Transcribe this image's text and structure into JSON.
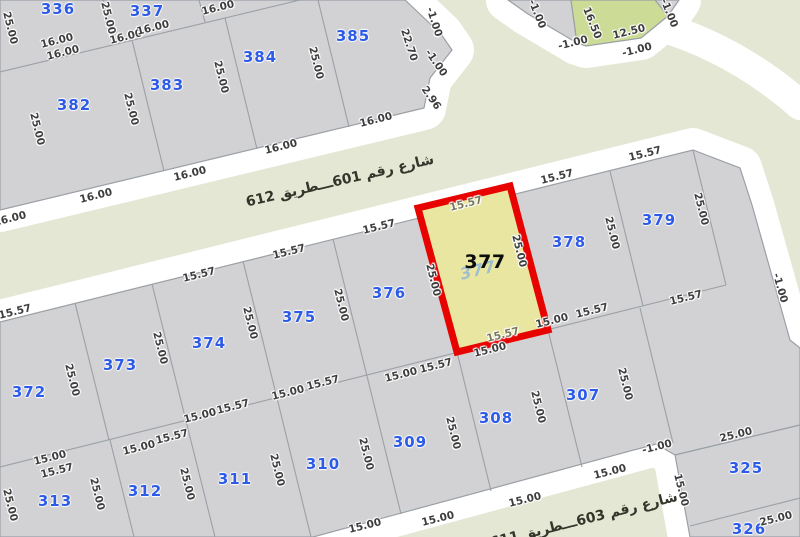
{
  "map": {
    "streets": [
      {
        "name": "شارع رقم 601ـــطريق 612",
        "x": 340,
        "y": 181,
        "rot": -13
      },
      {
        "name": "شارع رقم 603ـــطريق 611",
        "x": 584,
        "y": 520,
        "rot": -14
      }
    ],
    "selected_parcel": {
      "number": "377",
      "shadow_number": "377"
    },
    "parcel_numbers": [
      {
        "n": "336",
        "x": 58,
        "y": 9
      },
      {
        "n": "337",
        "x": 147,
        "y": 11
      },
      {
        "n": "382",
        "x": 74,
        "y": 105
      },
      {
        "n": "383",
        "x": 167,
        "y": 85
      },
      {
        "n": "384",
        "x": 260,
        "y": 57
      },
      {
        "n": "385",
        "x": 353,
        "y": 36
      },
      {
        "n": "372",
        "x": 29,
        "y": 392
      },
      {
        "n": "373",
        "x": 120,
        "y": 365
      },
      {
        "n": "374",
        "x": 209,
        "y": 343
      },
      {
        "n": "375",
        "x": 299,
        "y": 317
      },
      {
        "n": "376",
        "x": 389,
        "y": 293
      },
      {
        "n": "378",
        "x": 569,
        "y": 242
      },
      {
        "n": "379",
        "x": 659,
        "y": 220
      },
      {
        "n": "313",
        "x": 55,
        "y": 501
      },
      {
        "n": "312",
        "x": 145,
        "y": 491
      },
      {
        "n": "311",
        "x": 235,
        "y": 479
      },
      {
        "n": "310",
        "x": 323,
        "y": 464
      },
      {
        "n": "309",
        "x": 410,
        "y": 442
      },
      {
        "n": "308",
        "x": 496,
        "y": 418
      },
      {
        "n": "307",
        "x": 583,
        "y": 395
      },
      {
        "n": "325",
        "x": 746,
        "y": 468
      },
      {
        "n": "326",
        "x": 749,
        "y": 529
      }
    ],
    "dimensions": [
      {
        "t": "25.00",
        "x": 10,
        "y": 28,
        "r": 76
      },
      {
        "t": "16.00",
        "x": 57,
        "y": 41,
        "r": -14
      },
      {
        "t": "16.00",
        "x": 63,
        "y": 53,
        "r": -14
      },
      {
        "t": "25.00",
        "x": 108,
        "y": 18,
        "r": 76
      },
      {
        "t": "16.00",
        "x": 126,
        "y": 37,
        "r": -14
      },
      {
        "t": "16.00",
        "x": 153,
        "y": 28,
        "r": -14
      },
      {
        "t": "16.00",
        "x": 218,
        "y": 8,
        "r": -14
      },
      {
        "t": "25.00",
        "x": 37,
        "y": 129,
        "r": 76
      },
      {
        "t": "25.00",
        "x": 131,
        "y": 109,
        "r": 76
      },
      {
        "t": "25.00",
        "x": 221,
        "y": 77,
        "r": 76
      },
      {
        "t": "25.00",
        "x": 316,
        "y": 63,
        "r": 76
      },
      {
        "t": "22.70",
        "x": 409,
        "y": 45,
        "r": 72
      },
      {
        "t": "-1.00",
        "x": 434,
        "y": 22,
        "r": 72
      },
      {
        "t": "-1.00",
        "x": 436,
        "y": 63,
        "r": 55
      },
      {
        "t": "2.96",
        "x": 431,
        "y": 98,
        "r": 55
      },
      {
        "t": "16.00",
        "x": 10,
        "y": 219,
        "r": -14
      },
      {
        "t": "16.00",
        "x": 96,
        "y": 196,
        "r": -14
      },
      {
        "t": "16.00",
        "x": 190,
        "y": 174,
        "r": -14
      },
      {
        "t": "16.00",
        "x": 281,
        "y": 147,
        "r": -14
      },
      {
        "t": "16.00",
        "x": 376,
        "y": 120,
        "r": -14
      },
      {
        "t": "-1.00",
        "x": 537,
        "y": 14,
        "r": 68
      },
      {
        "t": "16.50",
        "x": 592,
        "y": 23,
        "r": 68
      },
      {
        "t": "12.50",
        "x": 629,
        "y": 32,
        "r": -14
      },
      {
        "t": "-1.00",
        "x": 573,
        "y": 43,
        "r": -14
      },
      {
        "t": "-1.00",
        "x": 637,
        "y": 50,
        "r": -14
      },
      {
        "t": "-1.00",
        "x": 669,
        "y": 13,
        "r": 68
      },
      {
        "t": "15.57",
        "x": 15,
        "y": 312,
        "r": -14
      },
      {
        "t": "15.57",
        "x": 199,
        "y": 275,
        "r": -14
      },
      {
        "t": "15.57",
        "x": 289,
        "y": 252,
        "r": -14
      },
      {
        "t": "15.57",
        "x": 379,
        "y": 227,
        "r": -14
      },
      {
        "t": "15.57",
        "x": 557,
        "y": 177,
        "r": -14
      },
      {
        "t": "15.57",
        "x": 645,
        "y": 154,
        "r": -14
      },
      {
        "t": "15.57",
        "x": 466,
        "y": 204,
        "r": -14,
        "onYellow": true
      },
      {
        "t": "25.00",
        "x": 433,
        "y": 280,
        "r": 76
      },
      {
        "t": "25.00",
        "x": 519,
        "y": 251,
        "r": 76
      },
      {
        "t": "15.57",
        "x": 503,
        "y": 335,
        "r": -14,
        "onYellow": true
      },
      {
        "t": "15.00",
        "x": 490,
        "y": 350,
        "r": -14
      },
      {
        "t": "25.00",
        "x": 72,
        "y": 380,
        "r": 76
      },
      {
        "t": "25.00",
        "x": 160,
        "y": 348,
        "r": 76
      },
      {
        "t": "25.00",
        "x": 250,
        "y": 323,
        "r": 76
      },
      {
        "t": "25.00",
        "x": 341,
        "y": 305,
        "r": 76
      },
      {
        "t": "25.00",
        "x": 612,
        "y": 233,
        "r": 76
      },
      {
        "t": "25.00",
        "x": 701,
        "y": 209,
        "r": 76
      },
      {
        "t": "-1.00",
        "x": 780,
        "y": 288,
        "r": 74
      },
      {
        "t": "15.00",
        "x": 50,
        "y": 458,
        "r": -14
      },
      {
        "t": "15.57",
        "x": 57,
        "y": 471,
        "r": -14
      },
      {
        "t": "15.00",
        "x": 139,
        "y": 448,
        "r": -14
      },
      {
        "t": "15.57",
        "x": 172,
        "y": 437,
        "r": -14
      },
      {
        "t": "15.00",
        "x": 200,
        "y": 416,
        "r": -14
      },
      {
        "t": "15.57",
        "x": 233,
        "y": 407,
        "r": -14
      },
      {
        "t": "15.00",
        "x": 288,
        "y": 393,
        "r": -14
      },
      {
        "t": "15.57",
        "x": 323,
        "y": 383,
        "r": -14
      },
      {
        "t": "15.00",
        "x": 401,
        "y": 375,
        "r": -14
      },
      {
        "t": "15.57",
        "x": 436,
        "y": 366,
        "r": -14
      },
      {
        "t": "15.00",
        "x": 552,
        "y": 321,
        "r": -14
      },
      {
        "t": "15.57",
        "x": 592,
        "y": 311,
        "r": -14
      },
      {
        "t": "15.57",
        "x": 686,
        "y": 298,
        "r": -14
      },
      {
        "t": "25.00",
        "x": 10,
        "y": 505,
        "r": 76
      },
      {
        "t": "25.00",
        "x": 97,
        "y": 494,
        "r": 76
      },
      {
        "t": "25.00",
        "x": 187,
        "y": 484,
        "r": 76
      },
      {
        "t": "25.00",
        "x": 277,
        "y": 470,
        "r": 76
      },
      {
        "t": "25.00",
        "x": 366,
        "y": 454,
        "r": 76
      },
      {
        "t": "25.00",
        "x": 453,
        "y": 433,
        "r": 76
      },
      {
        "t": "25.00",
        "x": 538,
        "y": 407,
        "r": 76
      },
      {
        "t": "25.00",
        "x": 625,
        "y": 384,
        "r": 76
      },
      {
        "t": "15.00",
        "x": 365,
        "y": 526,
        "r": -14
      },
      {
        "t": "15.00",
        "x": 438,
        "y": 519,
        "r": -14
      },
      {
        "t": "15.00",
        "x": 525,
        "y": 500,
        "r": -14
      },
      {
        "t": "15.00",
        "x": 610,
        "y": 472,
        "r": -14
      },
      {
        "t": "-1.00",
        "x": 657,
        "y": 447,
        "r": -14
      },
      {
        "t": "25.00",
        "x": 736,
        "y": 435,
        "r": -14
      },
      {
        "t": "15.00",
        "x": 681,
        "y": 490,
        "r": 76
      },
      {
        "t": "25.00",
        "x": 776,
        "y": 519,
        "r": -14
      }
    ],
    "colors": {
      "road_background": "#e3e7d3",
      "block_fill": "#d2d2d4",
      "block_line": "#9aa0a6",
      "road_edge": "#ffffff",
      "selected_fill": "#e8e6a0",
      "selected_border": "#e60300",
      "green_parcel_fill": "#ccdc96",
      "parcel_number_blue": "#2d5be8",
      "dimension_text": "#3d3d3d"
    }
  }
}
